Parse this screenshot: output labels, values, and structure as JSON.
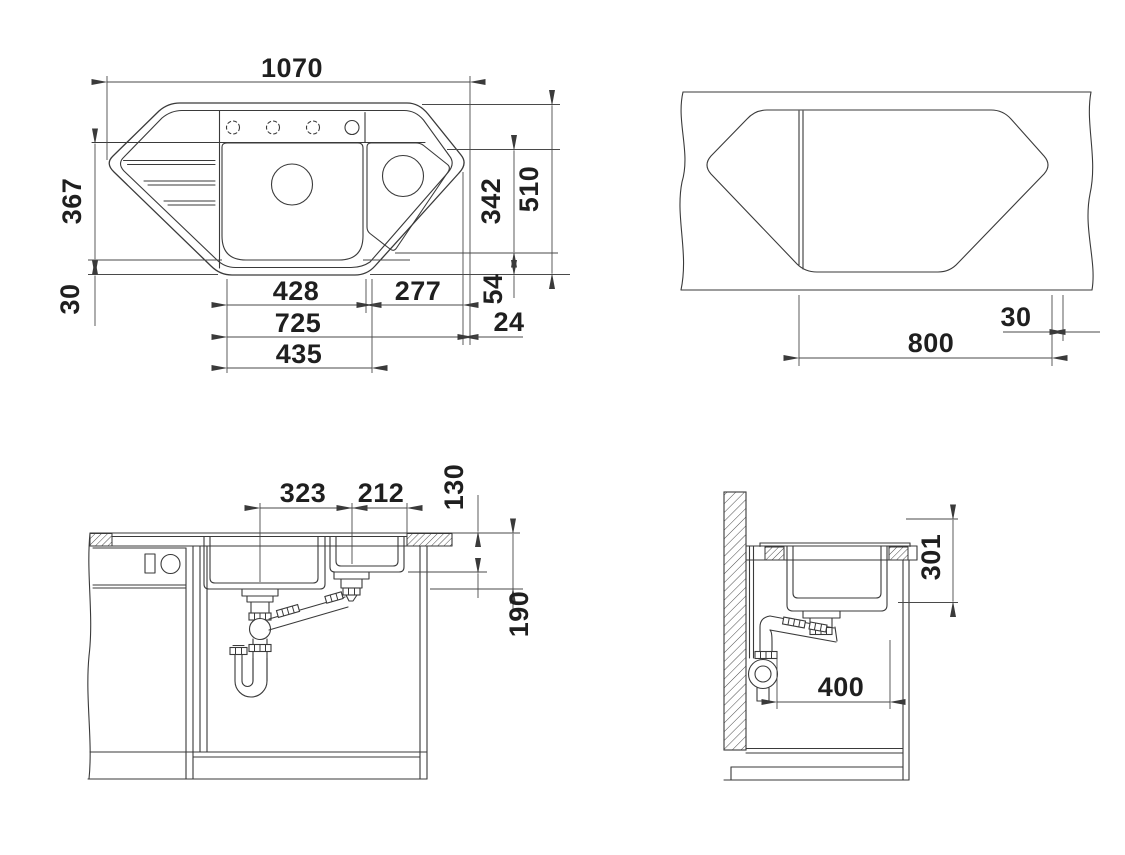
{
  "background": "#ffffff",
  "ink": "#3a3a3a",
  "text_color": "#1f1f1f",
  "views": {
    "plan": {
      "dims": {
        "overall_width": "1070",
        "drainer_depth": "367",
        "front_offset": "30",
        "main_bowl_width": "428",
        "small_bowl_width": "277",
        "bowls_span": "725",
        "main_bowl_outer": "435",
        "corner_bowl_depth": "342",
        "overall_depth": "510",
        "rear_edge": "54",
        "side_edge": "24"
      }
    },
    "cutout": {
      "dims": {
        "corner_span": "800",
        "edge_clearance": "30"
      }
    },
    "front_section": {
      "dims": {
        "main_drain_offset": "323",
        "small_drain_offset": "212",
        "small_bowl_depth": "130",
        "drain_height": "190"
      }
    },
    "side_section": {
      "dims": {
        "bowl_depth": "301",
        "trap_clearance": "400"
      }
    }
  }
}
